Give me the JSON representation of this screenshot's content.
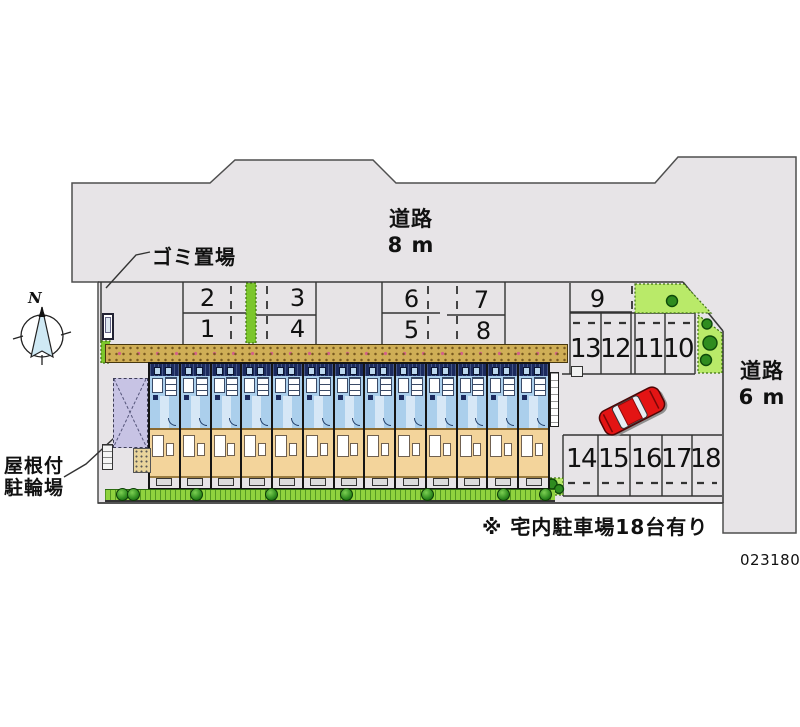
{
  "labels": {
    "road_top_name": "道路",
    "road_top_width": "8 m",
    "road_right_name": "道路",
    "road_right_width": "6 m",
    "garbage": "ゴミ置場",
    "bike_shed_line1": "屋根付",
    "bike_shed_line2": "駐輪場",
    "note": "※ 宅内駐車場18台有り",
    "plan_number": "023180",
    "compass_north": "N"
  },
  "parking": {
    "stalls": [
      "1",
      "2",
      "3",
      "4",
      "5",
      "6",
      "7",
      "8",
      "9",
      "10",
      "11",
      "12",
      "13",
      "14",
      "15",
      "16",
      "17",
      "18"
    ]
  },
  "building": {
    "unit_count": 13
  },
  "colors": {
    "road_gray": "#e7e4e7",
    "building_blue": "#abcfec",
    "building_tan": "#f3d49b",
    "roof_navy": "#1b2a5e",
    "wall_brick": "#cfae56",
    "hedge_green": "#7cc62c",
    "landscape_green": "#b9ea69",
    "bush_green": "#2f8c1f",
    "shed_lavender": "#c7c3e4",
    "car_red": "#e31414",
    "compass_blue": "#cfe9f4"
  }
}
